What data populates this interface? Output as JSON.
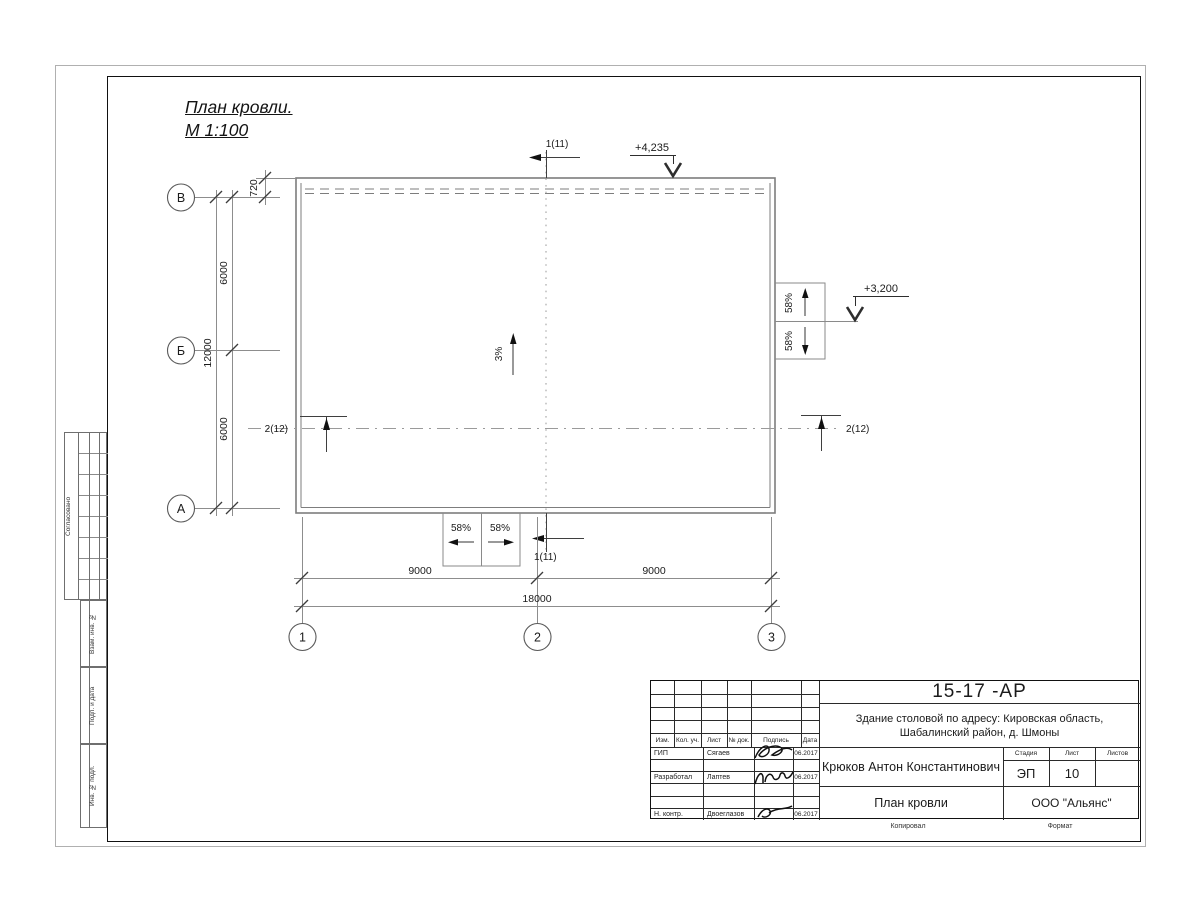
{
  "drawing_title": {
    "line1": "План кровли.",
    "line2": "М 1:100"
  },
  "side_stamp": {
    "agreed": "Согласовано",
    "subst_inv": "Взам. инв. №",
    "sign_date": "Подп. и дата",
    "inv_orig": "Инв. № подл."
  },
  "plan": {
    "axis_rows": [
      "В",
      "Б",
      "А"
    ],
    "axis_cols": [
      "1",
      "2",
      "3"
    ],
    "dims": {
      "parapet": "720",
      "bay_top": "6000",
      "total_left": "12000",
      "bay_bottom": "6000",
      "span_left": "9000",
      "span_right": "9000",
      "total_bottom": "18000"
    },
    "elevations": {
      "roof": "+4,235",
      "canopy": "+3,200"
    },
    "slopes": {
      "roof": "3%",
      "canopy": "58%"
    },
    "sections": {
      "s1": "1(11)",
      "s2": "2(12)"
    }
  },
  "title_block": {
    "code": "15-17 -АР",
    "project_line1": "Здание столовой по адресу: Кировская область,",
    "project_line2": "Шабалинский район, д. Шмоны",
    "author": "Крюков Антон Константинович",
    "doc_name": "План кровли",
    "company": "ООО \"Альянс\"",
    "columns": {
      "izm": "Изм.",
      "kol": "Кол. уч.",
      "list": "Лист",
      "doc": "№ док.",
      "sign": "Подпись",
      "date": "Дата"
    },
    "stage_label": "Стадия",
    "sheet_label": "Лист",
    "sheets_label": "Листов",
    "stage": "ЭП",
    "sheet_number": "10",
    "rows": [
      {
        "role": "ГИП",
        "name": "Сягаев",
        "date": "06.2017"
      },
      {
        "role": "Разработал",
        "name": "Лаптев",
        "date": "06.2017"
      },
      {
        "role": "Н. контр.",
        "name": "Двоеглазов",
        "date": "06.2017"
      }
    ],
    "footer": {
      "copied": "Копировал",
      "format": "Формат"
    }
  }
}
